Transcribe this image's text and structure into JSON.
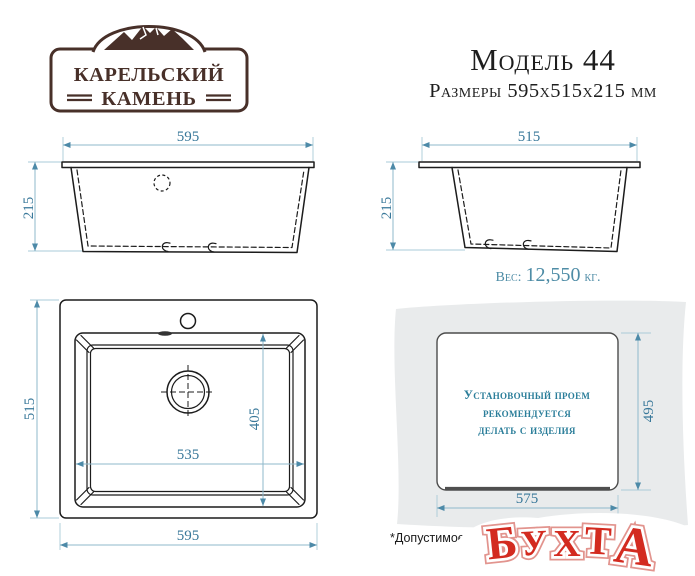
{
  "logo": {
    "line1": "КАРЕЛЬСКИЙ",
    "line2": "КАМЕНЬ"
  },
  "header": {
    "title": "Модель 44",
    "subtitle": "Размеры 595х515х215 мм"
  },
  "front_view": {
    "width": "595",
    "height": "215"
  },
  "side_view": {
    "width": "515",
    "height": "215"
  },
  "weight": {
    "label": "Вес:",
    "value": "12,550",
    "unit": "кг."
  },
  "top_view": {
    "side": "515",
    "width": "595",
    "inner_width": "535",
    "inner_depth": "405"
  },
  "cutout": {
    "height": "495",
    "width": "575",
    "note_line1": "Установочный проем",
    "note_line2": "рекомендуется",
    "note_line3": "делать с изделия"
  },
  "footnote": "*Допустимое",
  "watermark": {
    "text": "БУХТА",
    "letters": [
      "Б",
      "У",
      "Х",
      "Т",
      "А"
    ]
  },
  "colors": {
    "dimension_text": "#39789a",
    "dimension_line": "#8fb9cb",
    "drawing_line": "#1c1c1c",
    "brand_brown": "#483029",
    "note_teal": "#2b7e9a",
    "watermark_red": "#d32b20",
    "countertop_gray": "#e9ebec"
  }
}
